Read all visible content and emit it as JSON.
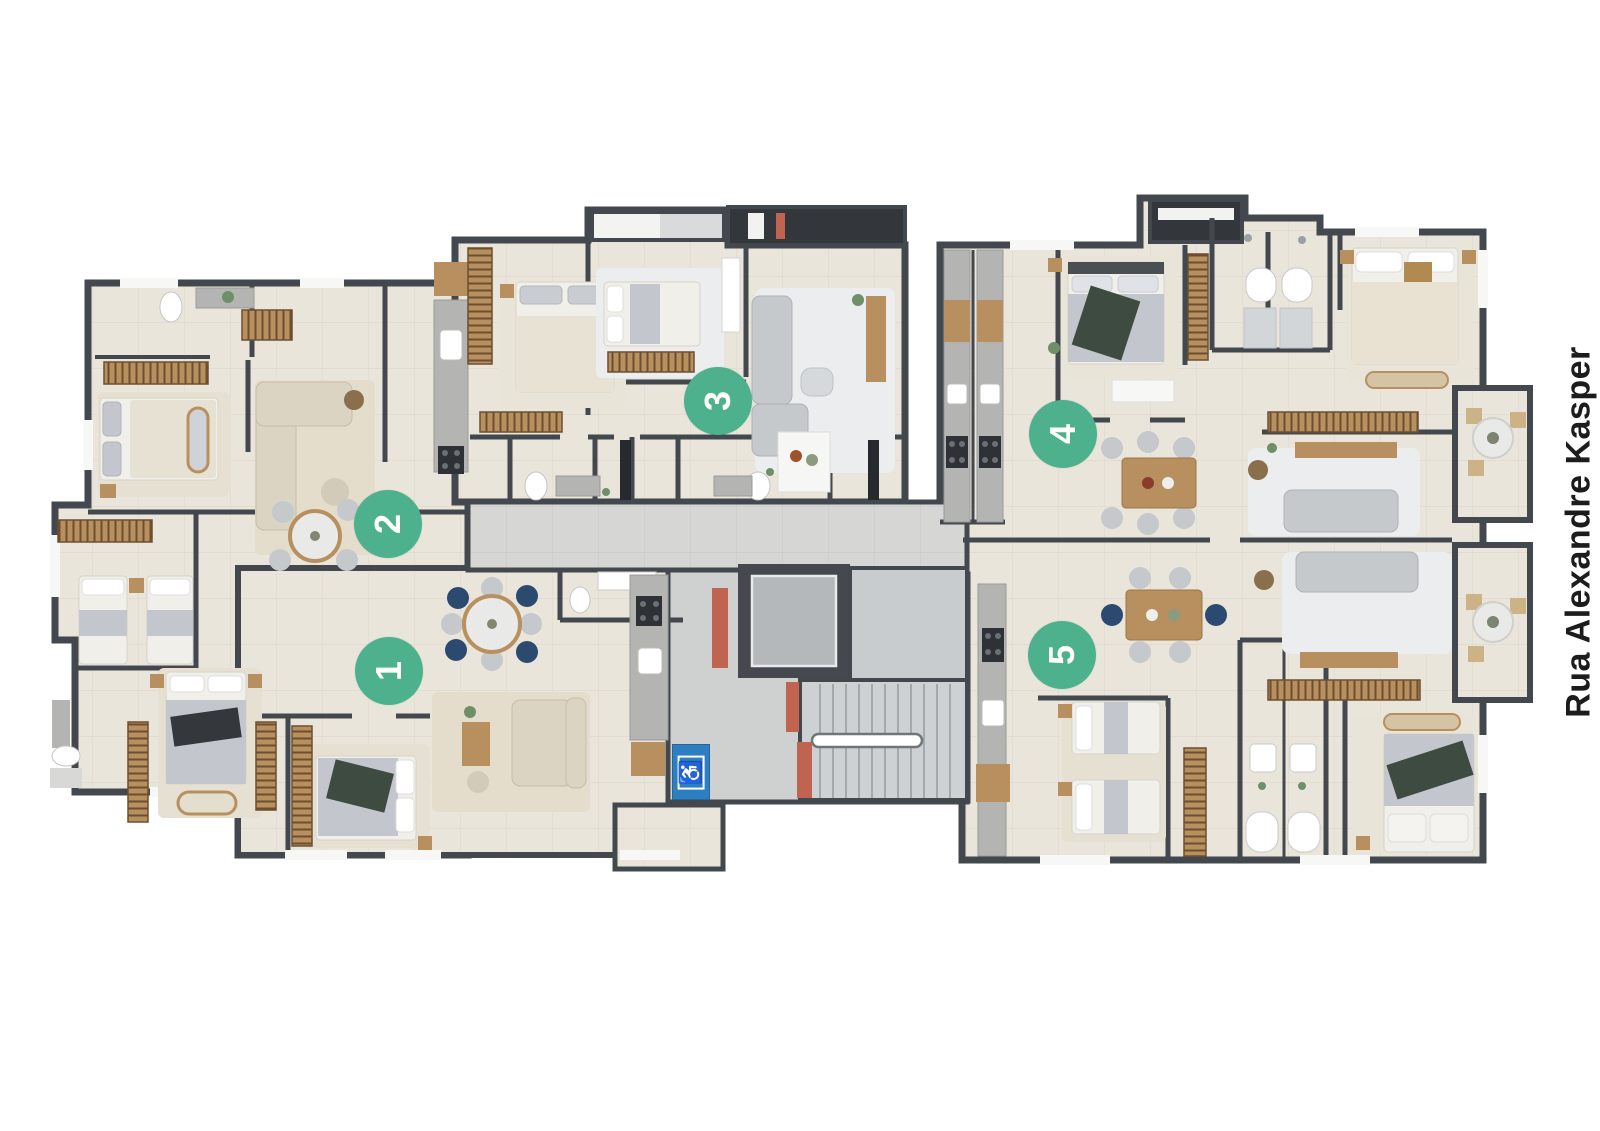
{
  "street_label": {
    "text": "Rua Alexandre Kasper"
  },
  "units": [
    {
      "number": "1"
    },
    {
      "number": "2"
    },
    {
      "number": "3"
    },
    {
      "number": "4"
    },
    {
      "number": "5"
    }
  ],
  "core": {
    "accessibility_glyph": "♿"
  },
  "palette": {
    "background": "#ffffff",
    "wall": "#43484e",
    "floor": "#eae5db",
    "floor_grout": "#dcd5c6",
    "corridor": "#d6d7d5",
    "corridor_grout": "#c6c8c7",
    "badge_green": "#4db18d",
    "badge_text": "#ffffff",
    "street_text": "#1c1c1c",
    "accent_red": "#c06351",
    "accessibility_blue": "#2d7fc1",
    "wood": "#b8905f",
    "wood_dark": "#6d4f2f",
    "granite": "#b4b5b3",
    "sofa_gray": "#c6c9cc",
    "sofa_beige": "#dcd4c3",
    "bed_sheet": "#f1efe9",
    "bed_blanket": "#c3c7cd",
    "bed_throw_green": "#3e4b41",
    "rug_beige": "#e4ddcb",
    "rug_gray": "#ebedee",
    "navy_chair": "#2c4a70",
    "stair": "#ced1d3",
    "elevator": "#b4b8bb",
    "service_dark": "#33373c"
  }
}
